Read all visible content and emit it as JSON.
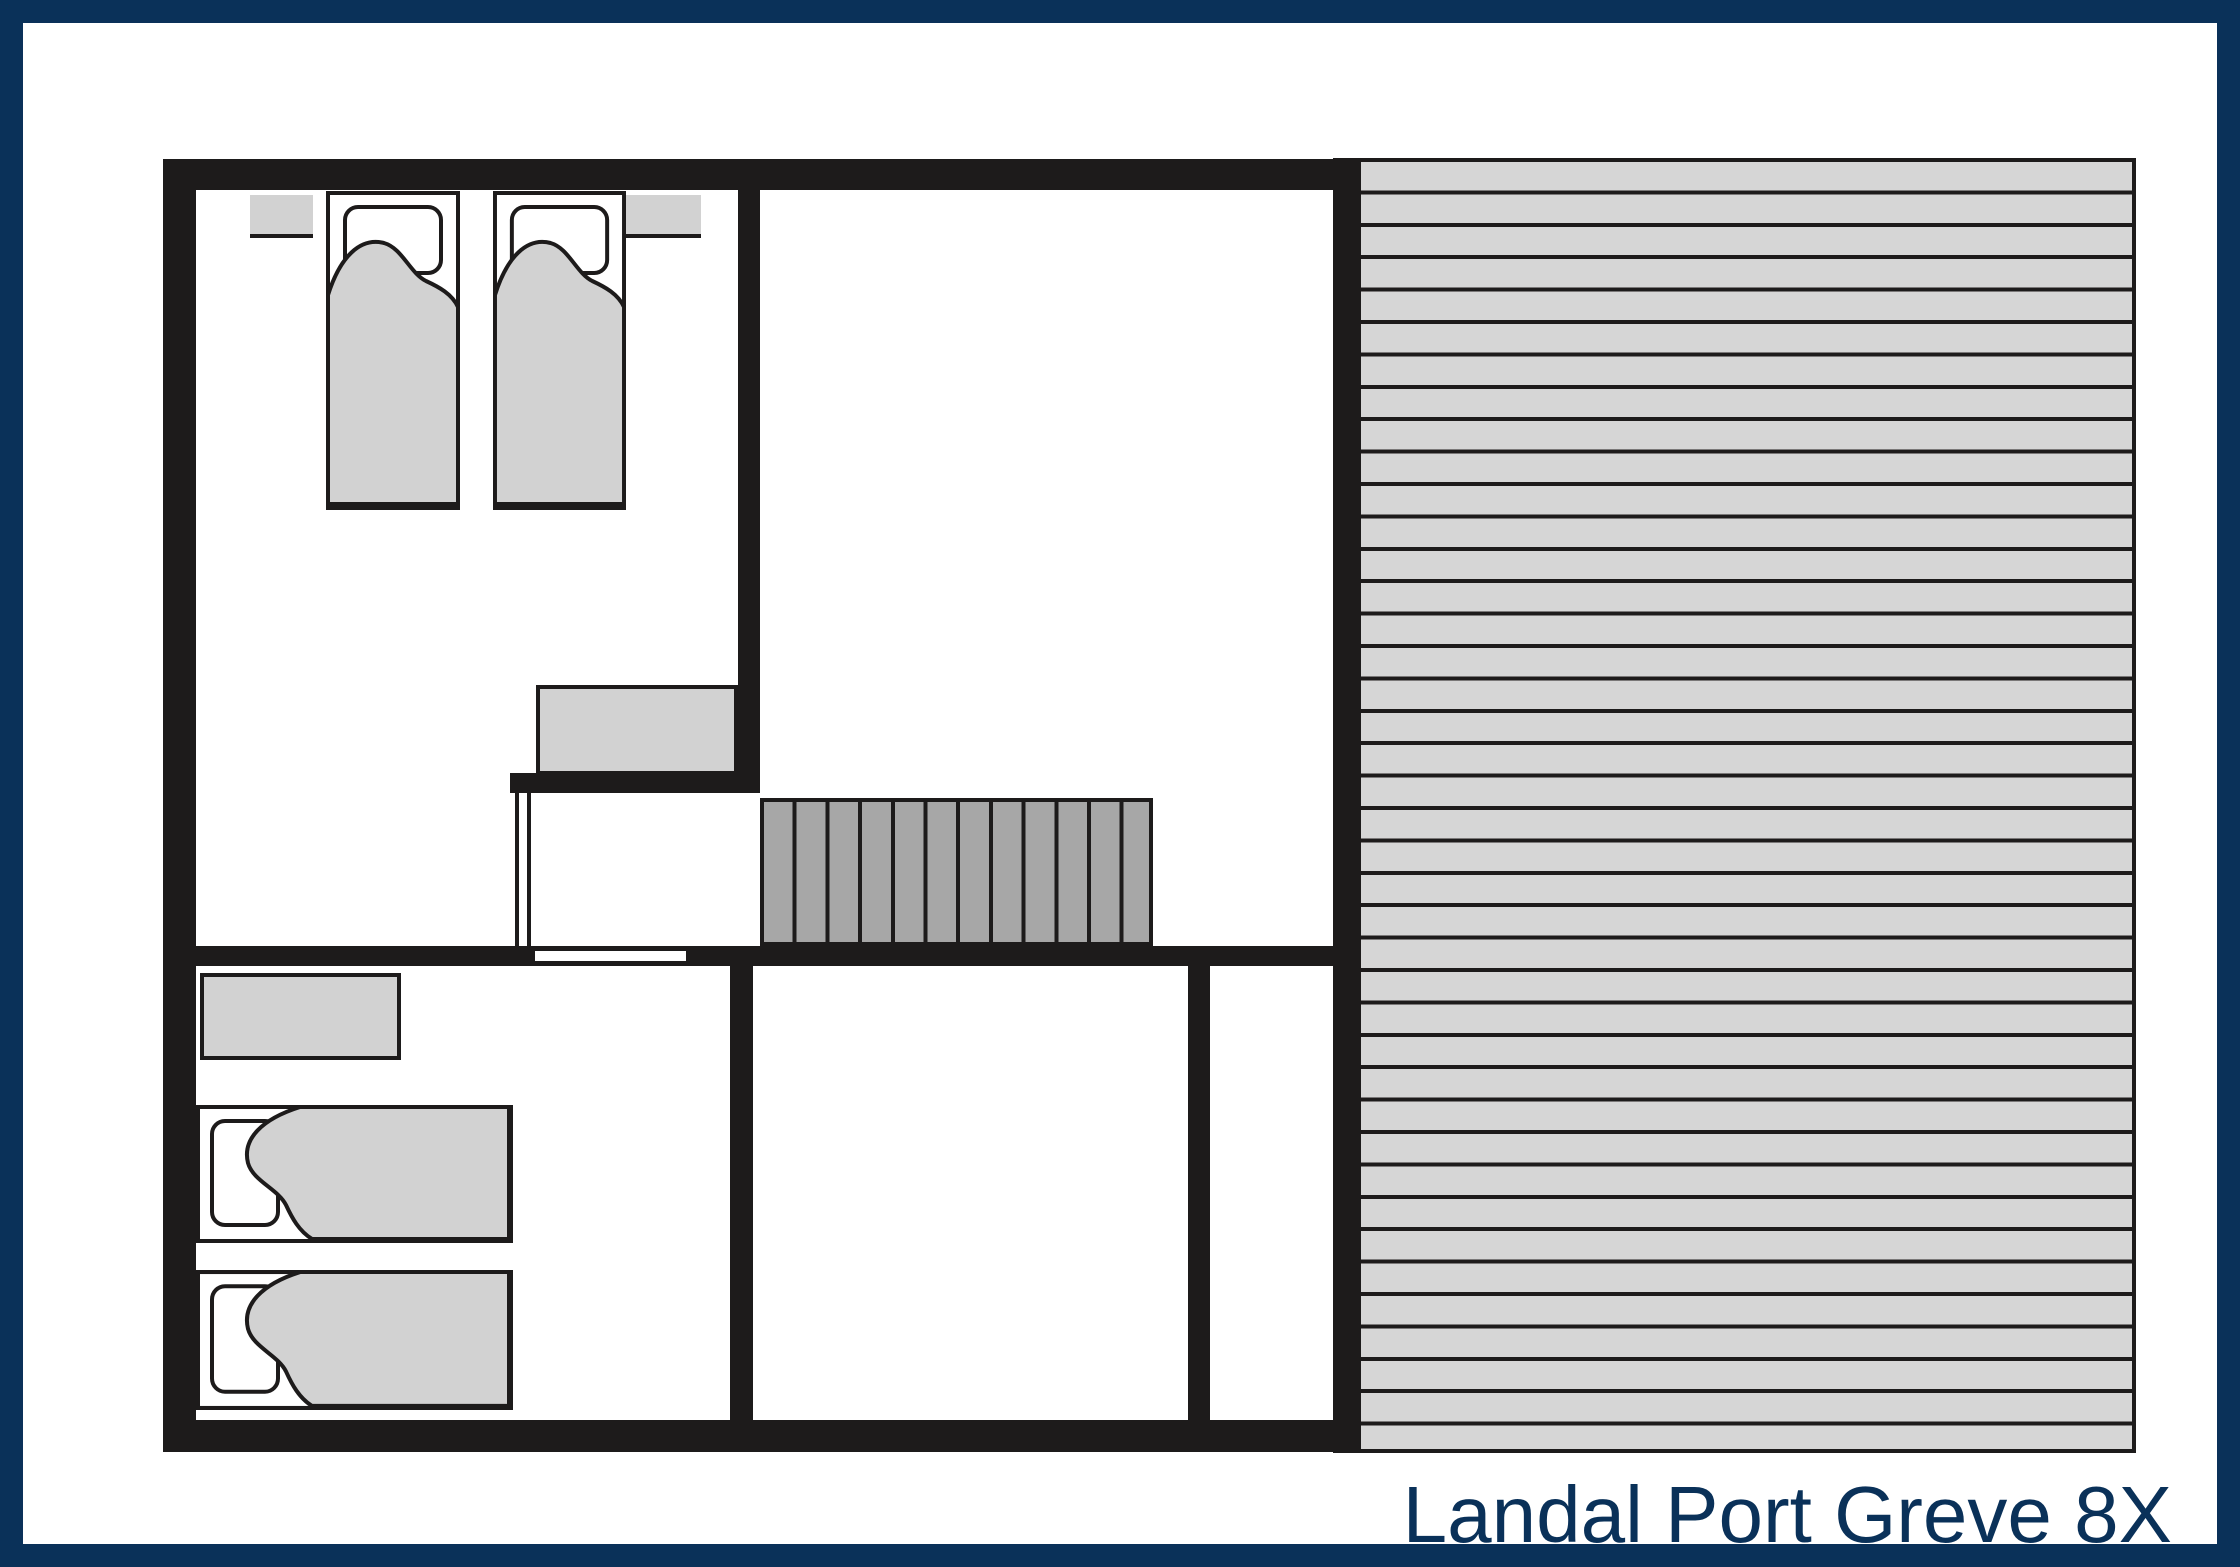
{
  "caption": {
    "text": "Landal Port Greve 8X"
  },
  "colors": {
    "frame_navy": "#0a3159",
    "wall_black": "#1d1b1b",
    "furniture_gray": "#d2d2d2",
    "stairs_gray": "#a7a7a7",
    "deck_gray": "#d6d6d6",
    "background": "#ffffff"
  }
}
